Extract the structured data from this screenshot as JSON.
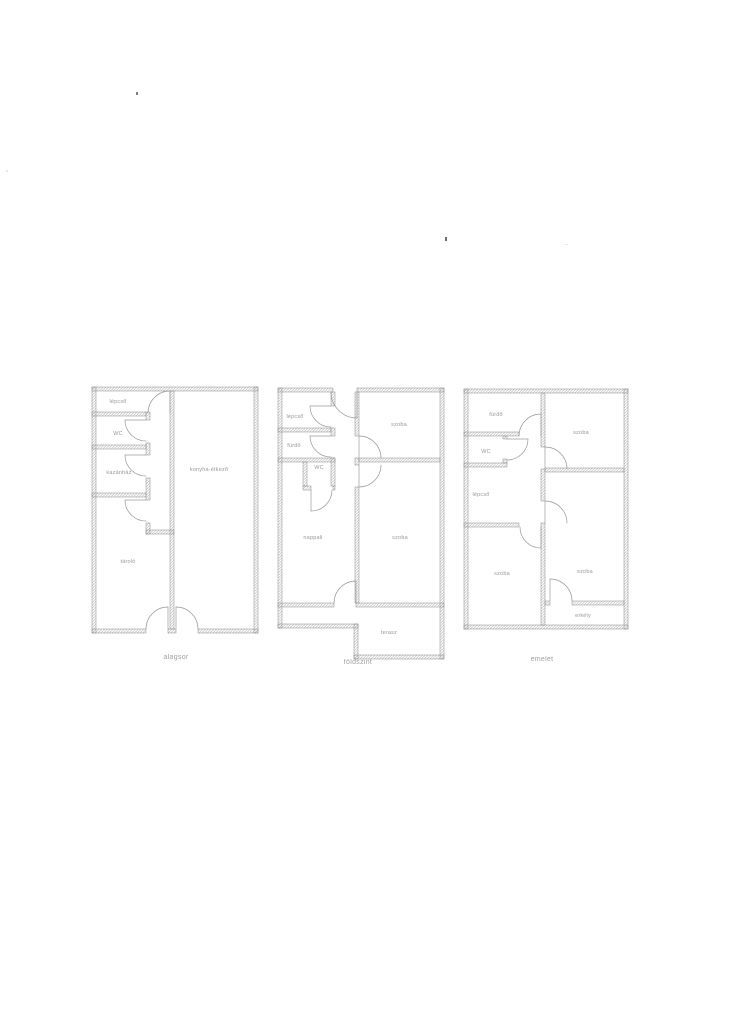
{
  "page": {
    "background": "#ffffff",
    "ink": "#8f8f8f",
    "wall_line_color": "#8a8a8a"
  },
  "plans": [
    {
      "floor_label": "alagsor",
      "rooms": [
        "lépcső",
        "WC",
        "kazánház",
        "tároló",
        "konyha-étkező"
      ]
    },
    {
      "floor_label": "földszint",
      "rooms": [
        "lépcső",
        "fürdő",
        "WC",
        "nappali",
        "szoba",
        "szoba",
        "terasz"
      ]
    },
    {
      "floor_label": "emelet",
      "rooms": [
        "fürdő",
        "WC",
        "lépcső",
        "szoba",
        "szoba",
        "szoba",
        "erkély"
      ]
    }
  ]
}
